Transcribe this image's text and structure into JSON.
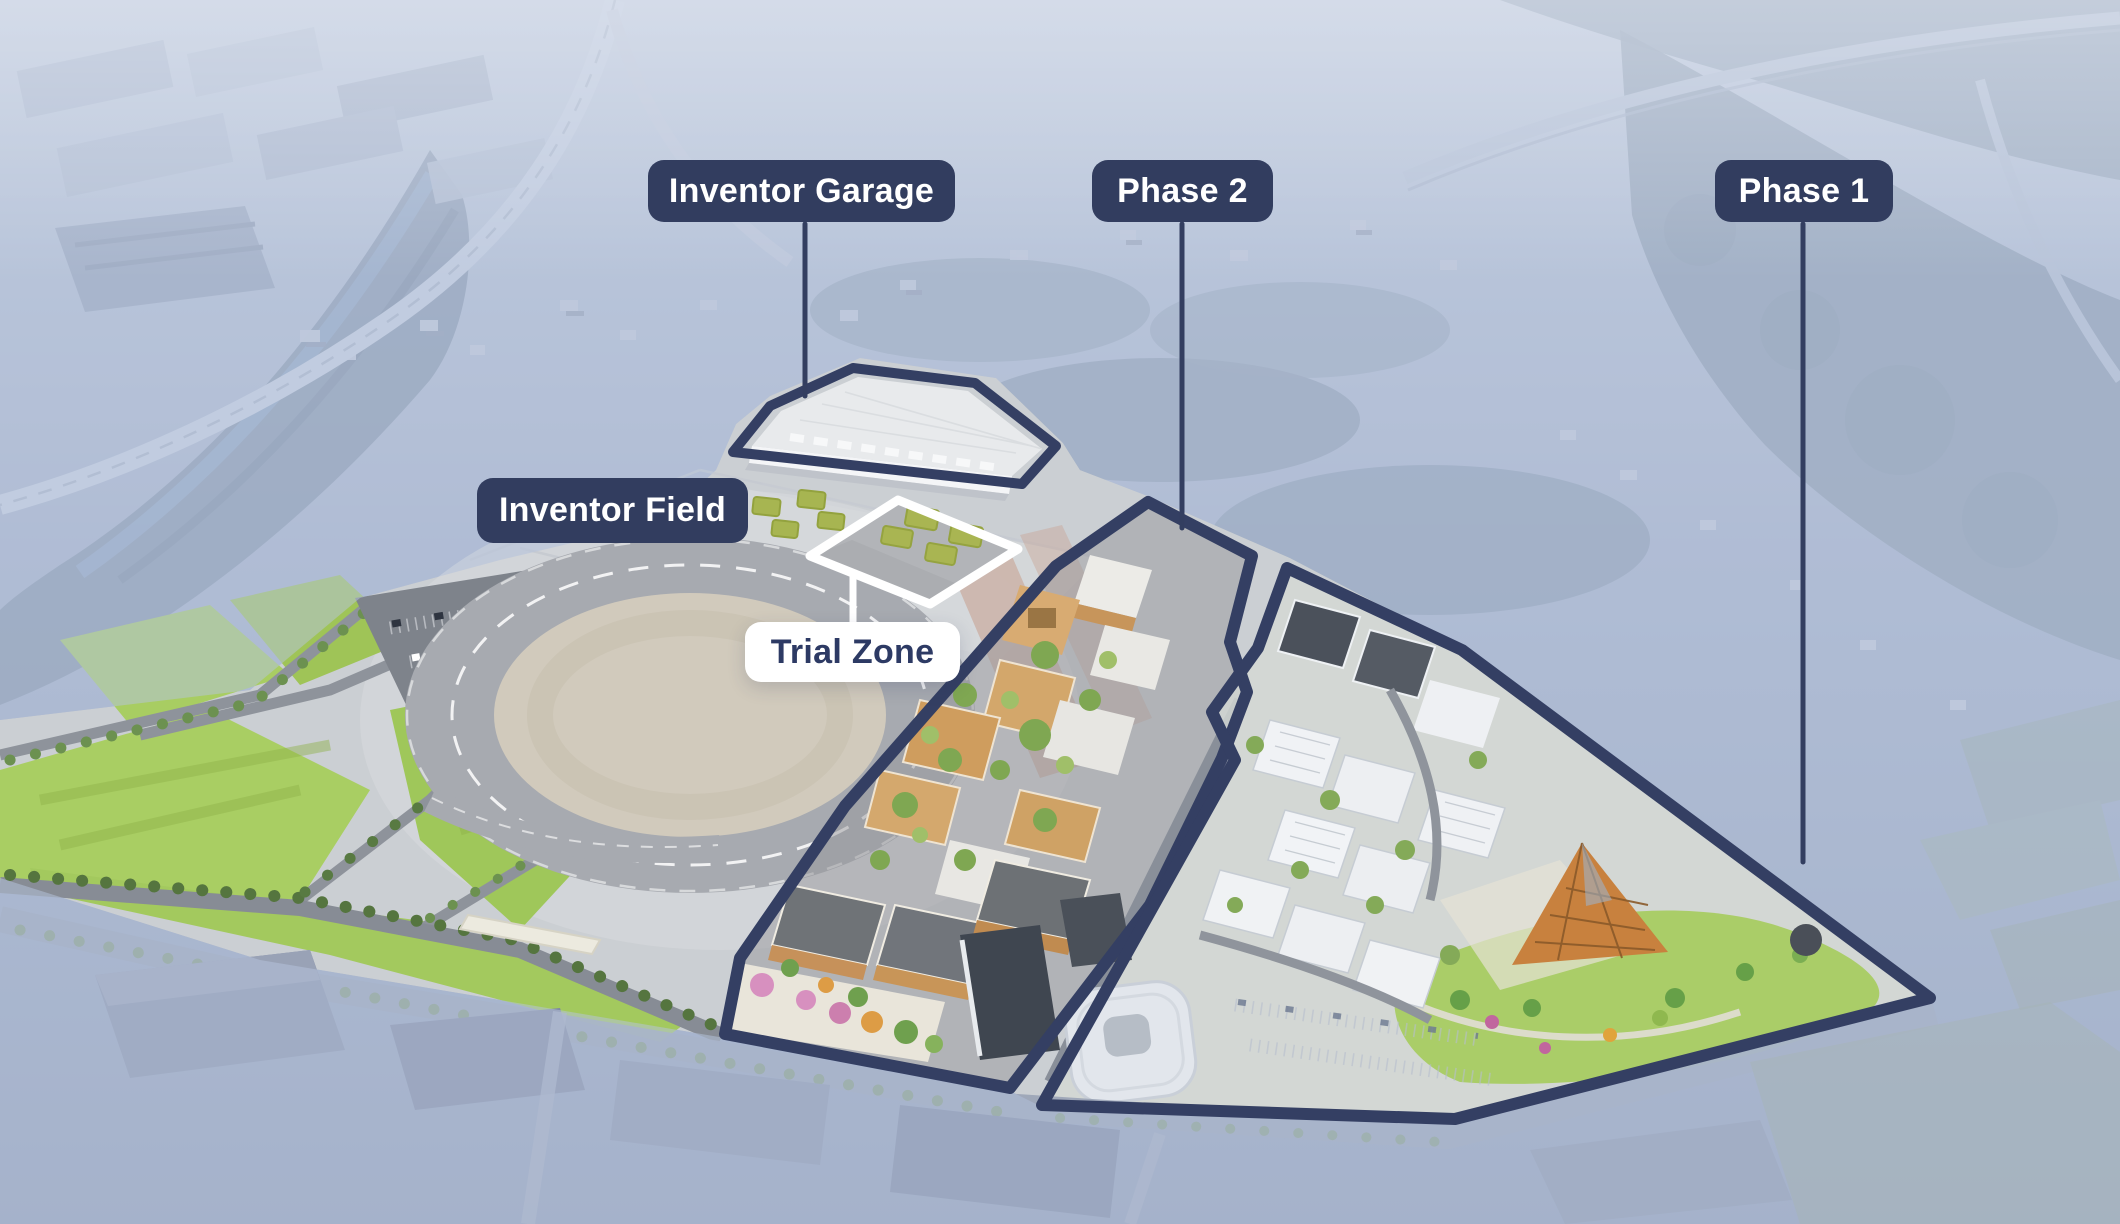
{
  "labels": {
    "inventor_garage": "Inventor Garage",
    "phase_2": "Phase 2",
    "phase_1": "Phase 1",
    "inventor_field": "Inventor Field",
    "trial_zone": "Trial Zone"
  },
  "colors": {
    "badge_navy": "#323d5f",
    "badge_text": "#ffffff",
    "trial_badge_bg": "#ffffff",
    "trial_badge_text": "#2d3a64",
    "zone_outline_navy": "#343f63",
    "trial_outline_white": "#ffffff"
  }
}
